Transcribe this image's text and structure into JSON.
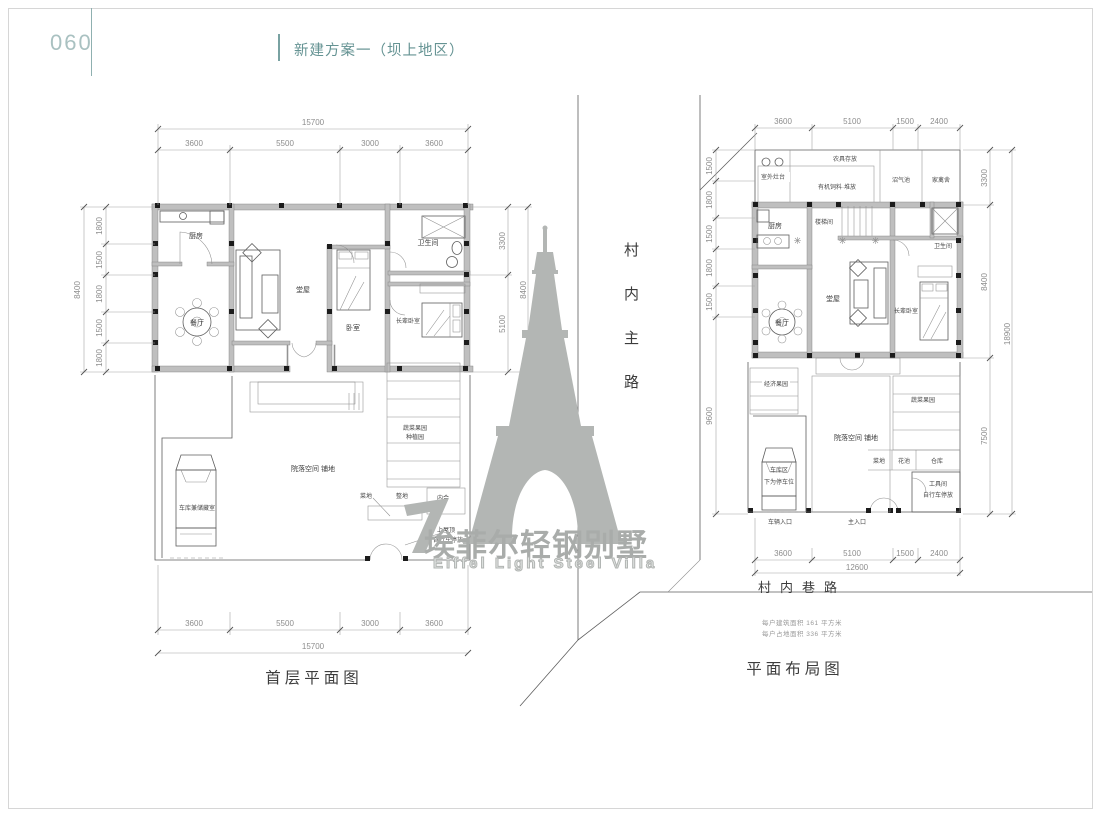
{
  "page": {
    "number": "060",
    "title": "新建方案一（坝上地区）"
  },
  "watermark": {
    "brand_cn": "埃菲尔轻钢别墅",
    "brand_en": "Eiffel Light Steel Villa"
  },
  "roads": {
    "main_road": "村内主路",
    "lane": "村内巷路"
  },
  "notes": {
    "line1": "每户建筑面积 161 平方米",
    "line2": "每户占地面积 336 平方米"
  },
  "left_plan": {
    "caption": "首层平面图",
    "total_width": "15700",
    "total_height": "8400",
    "top_segments": [
      "3600",
      "5500",
      "3000",
      "3600"
    ],
    "bottom_segments": [
      "3600",
      "5500",
      "3000",
      "3600"
    ],
    "left_segments": [
      "1800",
      "1500",
      "1800",
      "1500",
      "1800"
    ],
    "right_segments": [
      "3300",
      "5100"
    ],
    "rooms": {
      "kitchen": "厨房",
      "dining": "餐厅",
      "hall": "堂屋",
      "bedroom": "卧室",
      "bathroom": "卫生间",
      "elder_bedroom": "长辈卧室"
    },
    "site": {
      "garage": "车库兼储藏室",
      "courtyard": "院落空间 铺地",
      "orchard_line1": "蔬菜果园",
      "orchard_line2": "种植园",
      "plot_a": "菜地",
      "plot_b": "整地",
      "plot_c": "内合",
      "note_line1": "上屋顶",
      "note_line2": "自行车停放"
    }
  },
  "right_plan": {
    "caption": "平面布局图",
    "top_segments": [
      "3600",
      "5100",
      "1500",
      "2400"
    ],
    "bottom_segments": [
      "3600",
      "5100",
      "1500",
      "2400"
    ],
    "bottom_total": "12600",
    "left_segments": [
      "1500",
      "1800",
      "1500",
      "1800",
      "1500"
    ],
    "left_courtyard": "9600",
    "right_segments": [
      "3300",
      "8400",
      "7500"
    ],
    "right_total": "18900",
    "rooms": {
      "stove": "室外灶台",
      "compost": "有机饲料·堆放",
      "tool_storage": "农具存放",
      "biogas": "沼气池",
      "poultry": "家禽舍",
      "stair": "楼梯间",
      "kitchen": "厨房",
      "dining": "餐厅",
      "hall": "堂屋",
      "bathroom": "卫生间",
      "elder_bedroom": "长辈卧室"
    },
    "site": {
      "orchard_left": "经济果园",
      "carport_line1": "车库区",
      "carport_line2": "下为停车位",
      "courtyard": "院落空间 铺地",
      "orchard_right": "蔬菜果园",
      "plot_a": "菜地",
      "plot_b": "花池",
      "plot_c": "仓库",
      "tool_room_line1": "工具间",
      "tool_room_line2": "自行车停放",
      "entry_car": "车辆入口",
      "entry_main": "主入口"
    }
  }
}
